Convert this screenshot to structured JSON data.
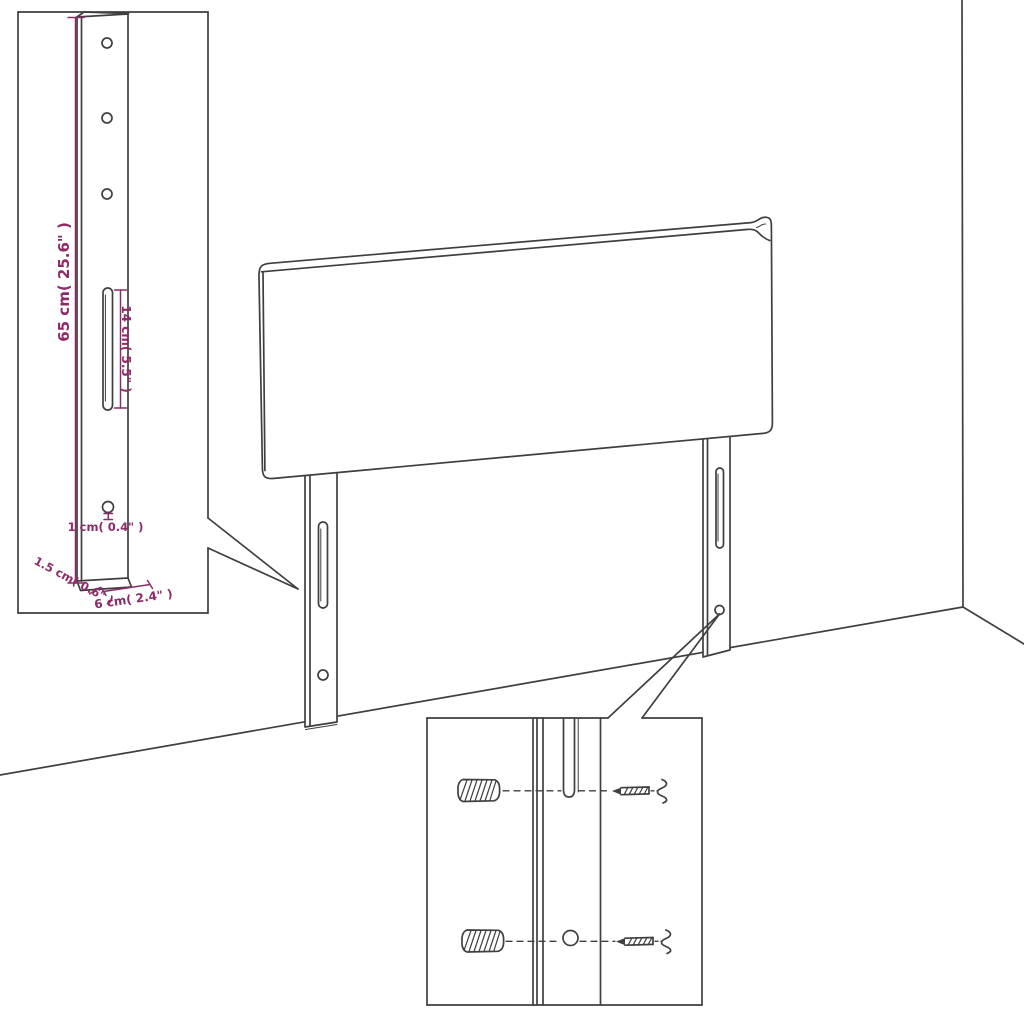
{
  "title": "Headboard mounting-leg assembly diagram",
  "colors": {
    "ink": "#3f3f3f",
    "accent": "#8e2a68",
    "paper": "#ffffff"
  },
  "dimensions": {
    "bracket_height": "65 cm( 25.6\" )",
    "slot_length": "14 cm( 5.5\" )",
    "hole_diameter": "1 cm( 0.4\" )",
    "bracket_thickness": "1.5 cm( 0.6\" )",
    "bracket_width": "6 cm( 2.4\" )"
  }
}
